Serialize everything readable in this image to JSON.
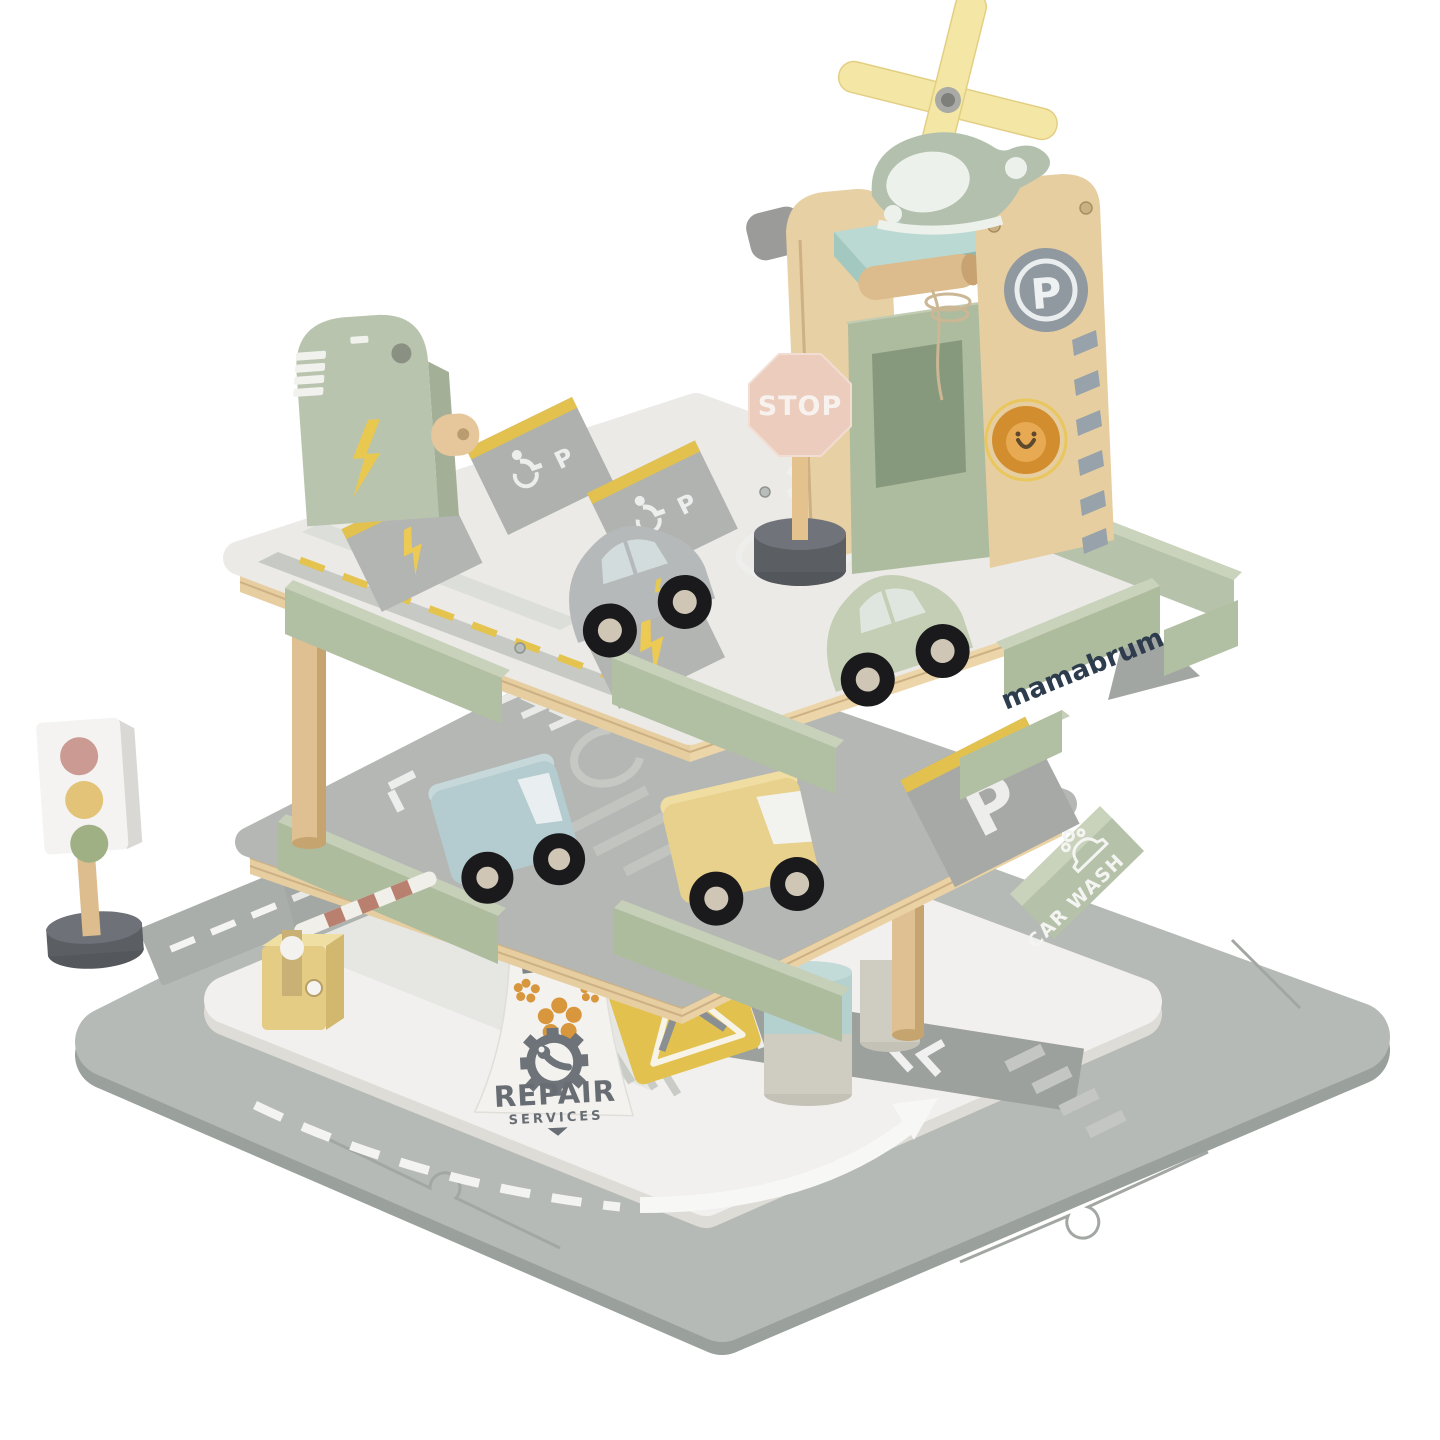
{
  "image": {
    "type": "product-photo",
    "subject": "Wooden toy three-level parking garage playset with helipad, vehicles and road mat",
    "brand": "mamabrum",
    "background": "#ffffff"
  },
  "labels": {
    "stop": "STOP",
    "parking": "P",
    "brand": "mamabrum",
    "car_wash": "CAR WASH",
    "repair": "REPAIR",
    "services": "SERVICES"
  },
  "palette": {
    "mat_gray": "#b6bab6",
    "mat_edge": "#9aa09c",
    "ground_white": "#f1f0ee",
    "deck_gray": "#b4b7b3",
    "deck_white": "#ebeae7",
    "plywood": "#e6cea1",
    "sage_green": "#aebc9e",
    "sage_light": "#c6cfb8",
    "helipad_teal": "#b9d9d2",
    "elevator_green": "#adbb9e",
    "rotor_yellow": "#f4e6a4",
    "heli_green": "#b3c0ae",
    "stop_pink": "#eccdbd",
    "accent_yellow": "#e2c14f",
    "dark_base": "#5b5e63",
    "wood": "#dfc092",
    "navy_text": "#2e3d4d",
    "lion_orange": "#d28d2e",
    "car_gray": "#b6b9ba",
    "car_green": "#c4ceb4",
    "van_blue": "#b4ccd0",
    "van_yellow": "#e8d18c",
    "wheel_black": "#1a1a1d",
    "hub_silver": "#cfc6b5",
    "road_dark": "#9da19d",
    "barrier_yellow": "#e4cc84",
    "stripe_red": "#b97f6f",
    "light_red": "#cb9a93",
    "light_yellow": "#e2c377",
    "light_green": "#9fb184",
    "repair_gray": "#6d7378",
    "flower_orange": "#d8963d"
  },
  "structure": {
    "base": "gray puzzle road mat with white dashed lane markings",
    "levels": [
      {
        "name": "rooftop-deck",
        "features": "helipad tower with winch lift, helicopter, STOP sign, EV charging station, 2 accessible P spots, EV lightning spots, parked gray and green cars"
      },
      {
        "name": "middle-deck",
        "features": "P parking spot, CAR WASH sign, parked blue and yellow vans, guardrails, brand sign"
      },
      {
        "name": "ground-level",
        "features": "REPAIR SERVICES ramp, tools warning zone, dark road with hatching and arrows, barrier gate, support pillars"
      }
    ]
  },
  "vehicles": [
    {
      "type": "helicopter",
      "color": "sage green",
      "location": "helipad"
    },
    {
      "type": "car",
      "color": "gray",
      "location": "rooftop deck"
    },
    {
      "type": "car",
      "color": "green",
      "location": "rooftop deck"
    },
    {
      "type": "van",
      "color": "blue",
      "location": "middle deck"
    },
    {
      "type": "van",
      "color": "yellow",
      "location": "middle deck"
    }
  ],
  "accessories": [
    {
      "name": "traffic-light",
      "lights": "red, yellow, green"
    },
    {
      "name": "stop-sign",
      "label": "STOP"
    },
    {
      "name": "barrier-gate",
      "stripes": "red and white"
    },
    {
      "name": "charging-station",
      "icons": "battery, lightning bolt"
    },
    {
      "name": "parking-sign",
      "label": "P"
    },
    {
      "name": "lion-sticker",
      "location": "tower panel"
    }
  ]
}
